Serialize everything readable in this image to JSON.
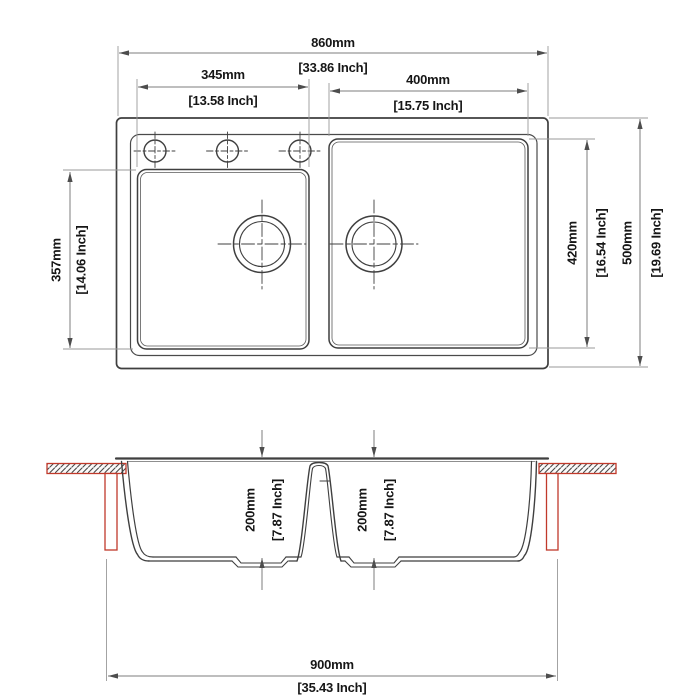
{
  "drawing": {
    "title": "Double bowl sink technical dimension drawing",
    "units": "mm / inch",
    "colors": {
      "line": "#3f3f3f",
      "dim_line": "#8a8a8a",
      "arrow": "#4d4d4d",
      "accent_red": "#c0392b",
      "text": "#161616",
      "background": "#ffffff"
    }
  },
  "views": {
    "top": {
      "name": "top view",
      "dims": {
        "overall_width": {
          "mm": "860mm",
          "inch": "[33.86 Inch]"
        },
        "left_bowl_width": {
          "mm": "345mm",
          "inch": "[13.58 Inch]"
        },
        "right_bowl_width": {
          "mm": "400mm",
          "inch": "[15.75 Inch]"
        },
        "left_bowl_length": {
          "mm": "357mm",
          "inch": "[14.06 Inch]"
        },
        "right_bowl_length": {
          "mm": "420mm",
          "inch": "[16.54 Inch]"
        },
        "overall_length": {
          "mm": "500mm",
          "inch": "[19.69 Inch]"
        }
      }
    },
    "section": {
      "name": "front section view",
      "dims": {
        "left_bowl_depth": {
          "mm": "200mm",
          "inch": "[7.87 Inch]"
        },
        "right_bowl_depth": {
          "mm": "200mm",
          "inch": "[7.87 Inch]"
        },
        "cutout_width": {
          "mm": "900mm",
          "inch": "[35.43 Inch]"
        }
      }
    }
  }
}
